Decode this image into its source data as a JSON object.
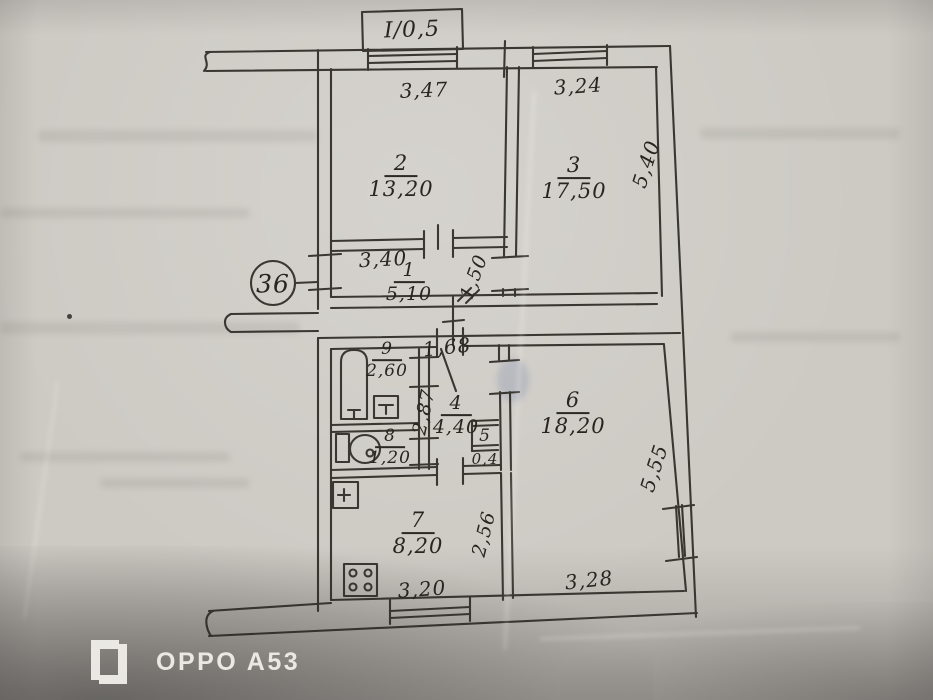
{
  "photo": {
    "watermark_text": "OPPO A53",
    "watermark_logo_icon": "oppo-brackets-logo"
  },
  "plan": {
    "apartment_number": "36",
    "balcony": {
      "label": "I/0,5"
    },
    "rooms": [
      {
        "number": "1",
        "area": "5,10"
      },
      {
        "number": "2",
        "area": "13,20"
      },
      {
        "number": "3",
        "area": "17,50"
      },
      {
        "number": "4",
        "area": "4,40"
      },
      {
        "number": "5",
        "area": "0,4"
      },
      {
        "number": "6",
        "area": "18,20"
      },
      {
        "number": "7",
        "area": "8,20"
      },
      {
        "number": "8",
        "area": "1,20"
      },
      {
        "number": "9",
        "area": "2,60"
      }
    ],
    "dimensions": {
      "room1_width": "3,40",
      "room1_depth": "1,50",
      "room2_width": "3,47",
      "room3_width": "3,24",
      "room3_depth": "5,40",
      "room4_width": "1,68",
      "room4_depth": "2,87",
      "room6_width": "3,28",
      "room6_depth": "5,55",
      "room7_width": "3,20",
      "room7_depth": "2,56"
    },
    "icons": {
      "fixtures": [
        "bathtub-icon",
        "washbasin-icon",
        "toilet-icon",
        "kitchen-sink-icon",
        "stove-icon"
      ],
      "openings": [
        "window-icon",
        "door-swing-icon"
      ]
    }
  }
}
